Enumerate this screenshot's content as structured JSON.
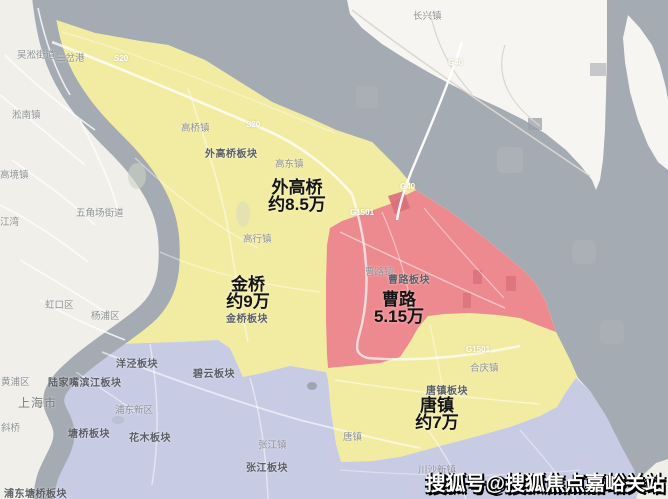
{
  "regions": [
    {
      "name": "外高桥",
      "price": "约8.5万"
    },
    {
      "name": "金桥",
      "price": "约9万"
    },
    {
      "name": "曹路",
      "price": "5.15万"
    },
    {
      "name": "唐镇",
      "price": "约7万"
    }
  ],
  "towns": [
    "吴淞街道",
    "三岔港",
    "淞南镇",
    "高境镇",
    "五角场街道",
    "江湾",
    "高桥镇",
    "高东镇",
    "高行镇",
    "长兴镇",
    "曹路镇",
    "合庆镇",
    "虹口区",
    "杨浦区",
    "黄浦区",
    "斜桥",
    "浦东新区",
    "张江镇",
    "唐镇",
    "川沙新镇"
  ],
  "sectors": [
    "外高桥板块",
    "曹路板块",
    "金桥板块",
    "唐镇板块",
    "洋泾板块",
    "碧云板块",
    "陆家嘴滨江板块",
    "塘桥板块",
    "花木板块",
    "张江板块",
    "浦东塘桥板块"
  ],
  "city": "上海市",
  "roads": [
    "S20",
    "S20",
    "G40",
    "G40",
    "G1501",
    "G1501"
  ],
  "watermark": "搜狐号@搜狐焦点嘉峪关站",
  "colors": {
    "water": "#a5abb2",
    "land": "#f0efe9",
    "island": "#f6f5f1",
    "yellow_region": "#f2eca3",
    "red_region": "#ec8a90",
    "red_dark_patch": "#d86f7a",
    "purple_region": "#c7cbe4",
    "price_text": "#141414",
    "watermark_text": "#ffffff"
  }
}
